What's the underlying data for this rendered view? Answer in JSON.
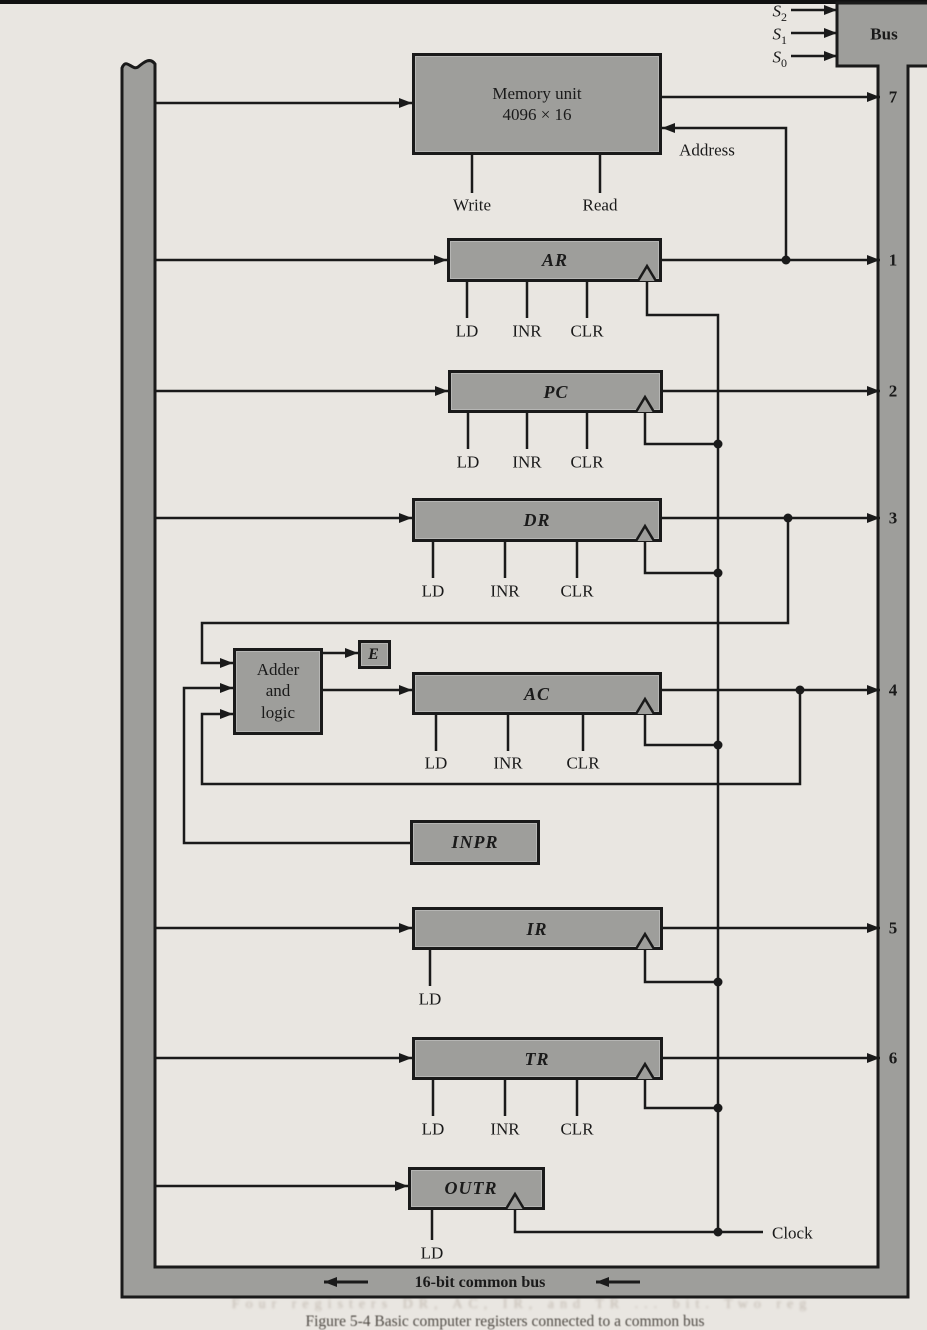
{
  "bus": {
    "label": "Bus",
    "numbers": [
      "7",
      "1",
      "2",
      "3",
      "4",
      "5",
      "6"
    ],
    "select": [
      {
        "base": "S",
        "sub": "2"
      },
      {
        "base": "S",
        "sub": "1"
      },
      {
        "base": "S",
        "sub": "0"
      }
    ],
    "common_label": "16-bit common bus"
  },
  "memory": {
    "title": "Memory unit",
    "size": "4096 × 16",
    "write": "Write",
    "read": "Read",
    "address": "Address"
  },
  "registers": {
    "ar": "AR",
    "pc": "PC",
    "dr": "DR",
    "ac": "AC",
    "inpr": "INPR",
    "ir": "IR",
    "tr": "TR",
    "outr": "OUTR"
  },
  "controls": {
    "ld": "LD",
    "inr": "INR",
    "clr": "CLR"
  },
  "adder": {
    "line1": "Adder",
    "line2": "and",
    "line3": "logic",
    "e": "E"
  },
  "clock_label": "Clock",
  "caption": "Figure 5-4   Basic computer registers connected to a common bus",
  "bleed_text": "Four registers DR, AC, IR, and TR ... bit. Two reg"
}
